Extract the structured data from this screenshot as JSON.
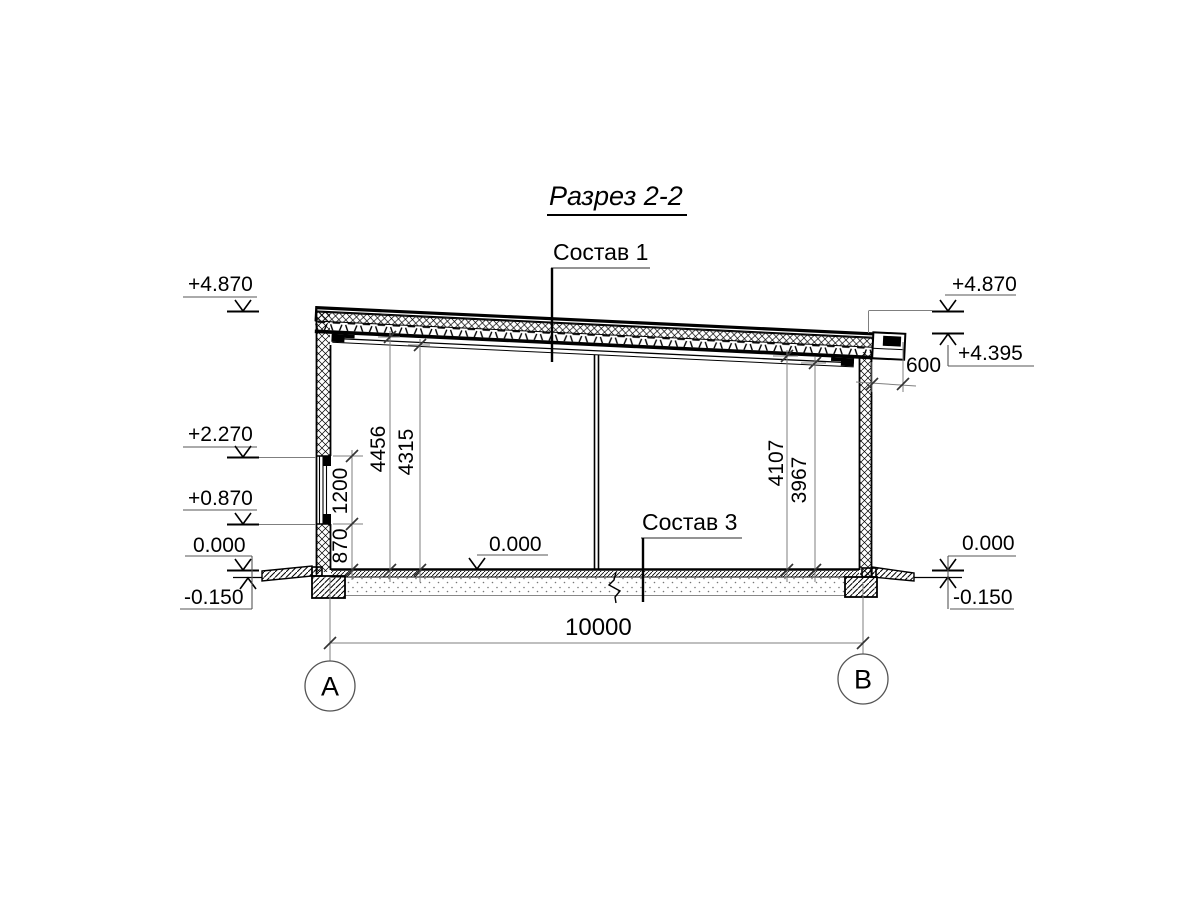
{
  "title": "Разрез 2-2",
  "callouts": {
    "sostav1": "Состав 1",
    "sostav3": "Состав 3"
  },
  "elevations": {
    "left": [
      "+4.870",
      "+2.270",
      "+0.870",
      "0.000",
      "-0.150"
    ],
    "right": [
      "+4.870",
      "+4.395",
      "0.000",
      "-0.150"
    ],
    "interior_floor": "0.000"
  },
  "dimensions": {
    "span": "10000",
    "roof_overhang": "600",
    "left_vertical": [
      "870",
      "1200",
      "4456",
      "4315"
    ],
    "right_vertical": [
      "4107",
      "3967"
    ]
  },
  "axes": {
    "a": "A",
    "b": "B"
  }
}
